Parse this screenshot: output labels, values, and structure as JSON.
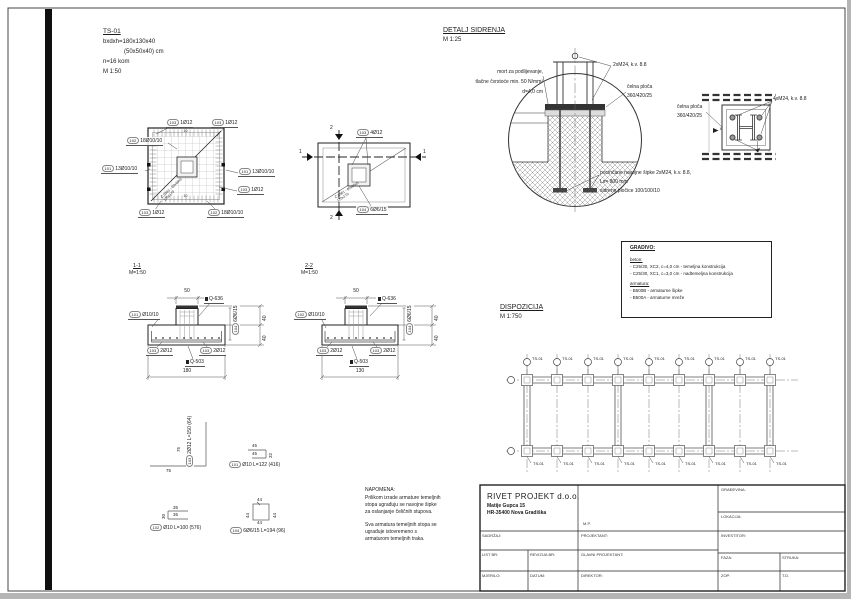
{
  "info": {
    "title": "TS-01",
    "dims": "bxdxh=180x130x40",
    "dims2": "(50x50x40) cm",
    "count": "n=16 kom",
    "scale": "M 1:50"
  },
  "plan1": {
    "labels": [
      {
        "pos": "103",
        "txt": "1Ø12"
      },
      {
        "pos": "103",
        "txt": "1Ø12"
      },
      {
        "pos": "102",
        "txt": "18Ø10/10"
      },
      {
        "pos": "101",
        "txt": "13Ø10/10"
      },
      {
        "pos": "101",
        "txt": "13Ø10/10"
      },
      {
        "pos": "103",
        "txt": "1Ø12"
      },
      {
        "pos": "103",
        "txt": "1Ø12"
      },
      {
        "pos": "102",
        "txt": "18Ø10/10"
      }
    ],
    "diag1": "Č.0361 - 60x60x5",
    "diag2": "120x170",
    "tick": "10"
  },
  "plan2": {
    "label_top": {
      "pos": "103",
      "txt": "4Ø12"
    },
    "label_bot": {
      "pos": "104",
      "txt": "6Ø6/15"
    },
    "sec_h": "1",
    "sec_v": "2",
    "diag1": "Č.0361 - 60x60x5",
    "diag2": "120x170"
  },
  "sec11": {
    "title": "1-1",
    "scale": "M=1:50",
    "dim_top": "50",
    "dim_bot": "180",
    "dim_r": "40",
    "mesh_top": "Q-636",
    "mesh_bot": "Q-503",
    "lbl_left": {
      "pos": "101",
      "txt": "Ø10/10"
    },
    "lbl_bl": {
      "pos": "103",
      "txt": "2Ø12"
    },
    "lbl_br": {
      "pos": "103",
      "txt": "2Ø12"
    },
    "lbl_vert": {
      "pos": "104",
      "txt": "6Ø6/15"
    }
  },
  "sec22": {
    "title": "2-2",
    "scale": "M=1:50",
    "dim_top": "50",
    "dim_bot": "130",
    "dim_r": "40",
    "mesh_top": "Q-636",
    "mesh_bot": "Q-503",
    "lbl_left": {
      "pos": "102",
      "txt": "Ø10/10"
    },
    "lbl_bl": {
      "pos": "103",
      "txt": "2Ø12"
    },
    "lbl_br": {
      "pos": "103",
      "txt": "2Ø12"
    },
    "lbl_vert": {
      "pos": "104",
      "txt": "6Ø6/15"
    }
  },
  "schedule": {
    "items": [
      {
        "pos": "103",
        "txt": "2Ø12  L=150 (64)",
        "d1": "75",
        "d2": "75"
      },
      {
        "pos": "101",
        "txt": "Ø10  L=122 (416)",
        "d1": "45",
        "d2": "45",
        "d3": "32"
      },
      {
        "pos": "102",
        "txt": "Ø10  L=100 (576)",
        "d1": "35",
        "d2": "35",
        "d3": "30"
      },
      {
        "pos": "104",
        "txt": "6Ø6/15  L=194 (96)",
        "d1": "44",
        "d2": "44",
        "d3": "44",
        "d4": "44"
      }
    ]
  },
  "napomena": {
    "title": "NAPOMENA:",
    "p1": [
      "Prilikom izrade armature temeljnih",
      "stopa ugrađuju se navojne šipke",
      "za oslanjanje čeličnih stupova."
    ],
    "p2": [
      "Sva armatura temeljnih stopa se",
      "ugrađuje istovremeno s",
      "armaturom temeljnih traka."
    ]
  },
  "detalj": {
    "title": "DETALJ SIDRENJA",
    "scale": "M 1:25",
    "mort": [
      "mort za podlijevanje,",
      "tlačne čvrstoće min. 50 N/mm²",
      "d=4,0 cm"
    ],
    "bolts": "2xM24, k.v. 8.8",
    "plate1": "čelna ploča",
    "plate2": "360/420/25",
    "anchor": [
      "pocinčane navojne šipke 2xM24, k.v. 8.8,",
      "Ls= 800 mm",
      "sidrene pločice 100/100/10"
    ]
  },
  "plate_detail": {
    "plate1": "čelna ploča",
    "plate2": "360/420/25",
    "bolts": "4xM24, k.v. 8.8",
    "weld": "6"
  },
  "gradivo": {
    "title": "GRADIVO:",
    "beton_h": "beton:",
    "beton": [
      "- C25/30, XC2, c=4,0 cm - temeljna konstrukcija",
      "- C25/30, XC1, c=3,0 cm - nadtemeljna konstrukcija"
    ],
    "arm_h": "armatura:",
    "armatura": [
      "- B500B - armaturne šipke",
      "- B500A - armaturne mreže"
    ]
  },
  "dispozicija": {
    "title": "DISPOZICIJA",
    "scale": "M 1:750",
    "footing": "TS-01"
  },
  "titleblock": {
    "company": "RIVET PROJEKT d.o.o.",
    "addr1": "Matije Gupca 15",
    "addr2": "HR-35400 Nova Gradiška",
    "mp": "M.P.",
    "gradjevina": "GRAĐEVINA:",
    "lokacija": "LOKACIJA:",
    "investitor": "INVESTITOR:",
    "sadrzaj": "SADRŽAJ:",
    "projektant": "PROJEKTANT:",
    "list_br": "LIST BR:",
    "revizija_br": "REVIZIJA BR:",
    "glavni": "GLAVNI PROJEKTANT:",
    "faza": "FAZA:",
    "struka": "STRUKA:",
    "mjerilo": "MJERILO:",
    "datum": "DATUM:",
    "direktor": "DIREKTOR:",
    "zop": "ZOP:",
    "td": "T.D."
  }
}
